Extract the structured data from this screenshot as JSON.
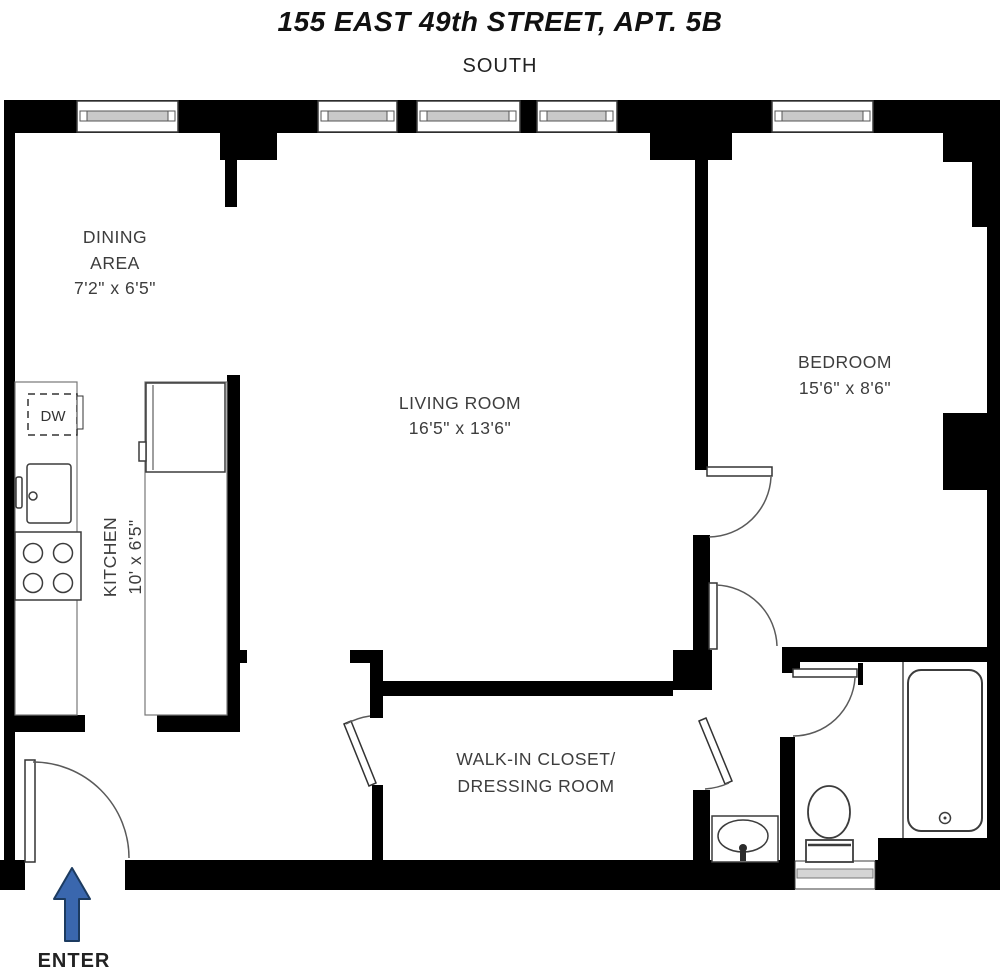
{
  "title": "155 EAST 49th STREET, APT. 5B",
  "orientation_label": "SOUTH",
  "rooms": {
    "dining": {
      "name_line1": "DINING",
      "name_line2": "AREA",
      "dims": "7'2\" x 6'5\""
    },
    "living": {
      "name": "LIVING ROOM",
      "dims": "16'5\" x 13'6\""
    },
    "bedroom": {
      "name": "BEDROOM",
      "dims": "15'6\" x 8'6\""
    },
    "kitchen": {
      "name": "KITCHEN",
      "dims": "10' x 6'5\""
    },
    "closet": {
      "name_line1": "WALK-IN CLOSET/",
      "name_line2": "DRESSING ROOM"
    }
  },
  "fixtures": {
    "dishwasher_label": "DW"
  },
  "entry": {
    "label": "ENTER"
  },
  "colors": {
    "wall": "#000000",
    "text": "#3d3d3d",
    "arrow_fill": "#3a67ae",
    "arrow_stroke": "#1c3b60",
    "window_sill": "#c9c9c9"
  }
}
